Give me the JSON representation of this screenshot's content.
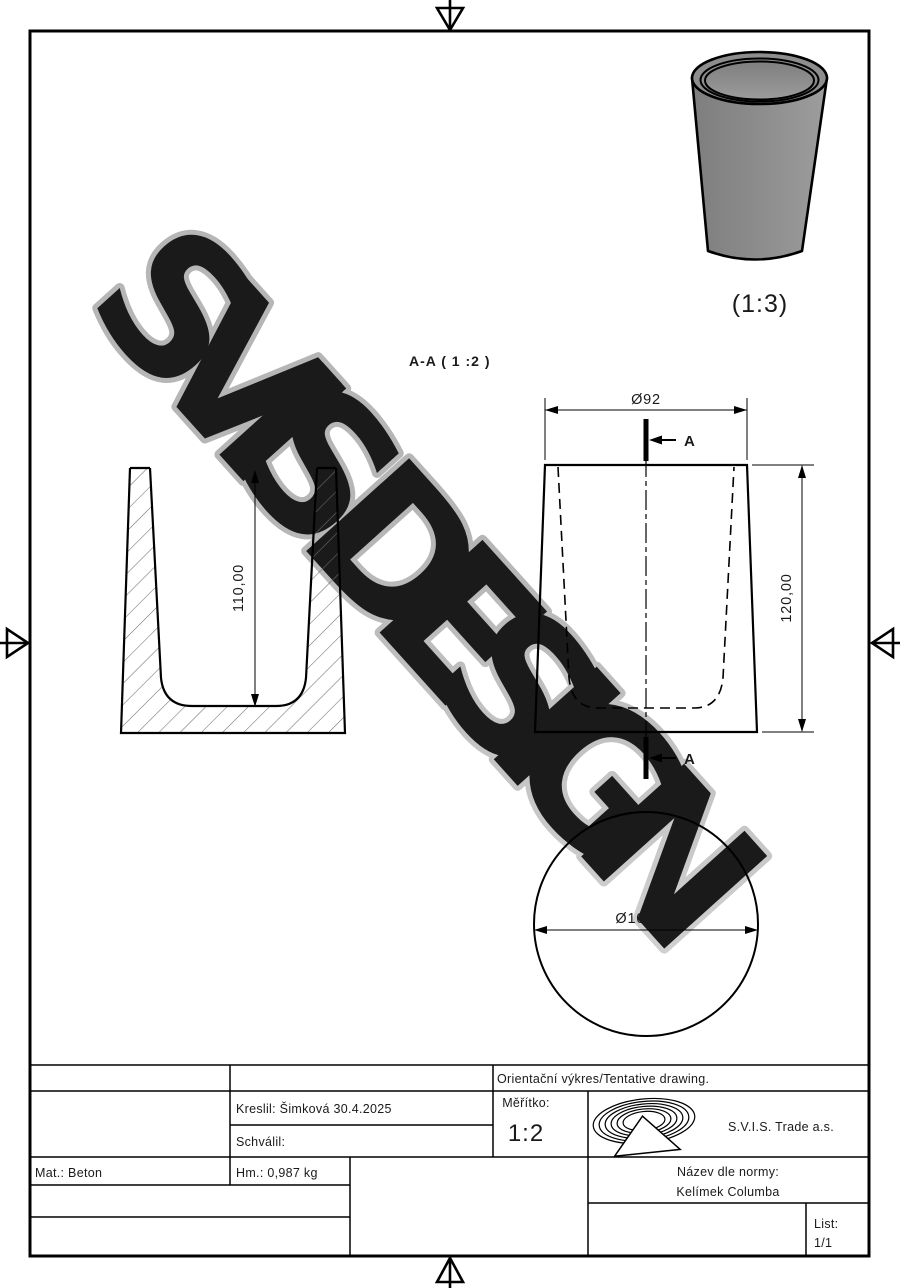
{
  "watermark": "SVIS DESIGN",
  "drawing": {
    "section_label": "A-A ( 1 :2 )",
    "view3d_scale": "(1:3)",
    "section_arrow_label": "A",
    "dims": {
      "top_diameter": "Ø92",
      "height": "120,00",
      "inner_depth": "110,00",
      "base_diameter": "Ø100,00"
    }
  },
  "title_block": {
    "tentative": "Orientační výkres/Tentative drawing.",
    "drawn_by": "Kreslil: Šimková 30.4.2025",
    "approved_by": "Schválil:",
    "scale_label": "Měřítko:",
    "scale_value": "1:2",
    "company": "S.V.I.S. Trade a.s.",
    "material": "Mat.: Beton",
    "mass": "Hm.: 0,987 kg",
    "name_label": "Název dle normy:",
    "name_value": "Kelímek Columba",
    "sheet_label": "List:",
    "sheet_value": "1/1"
  },
  "colors": {
    "line": "#000000",
    "watermark_gray": "#bfbfbf",
    "cup_body_gray": "#8a8a8a",
    "cup_inner_gray": "#858585"
  }
}
